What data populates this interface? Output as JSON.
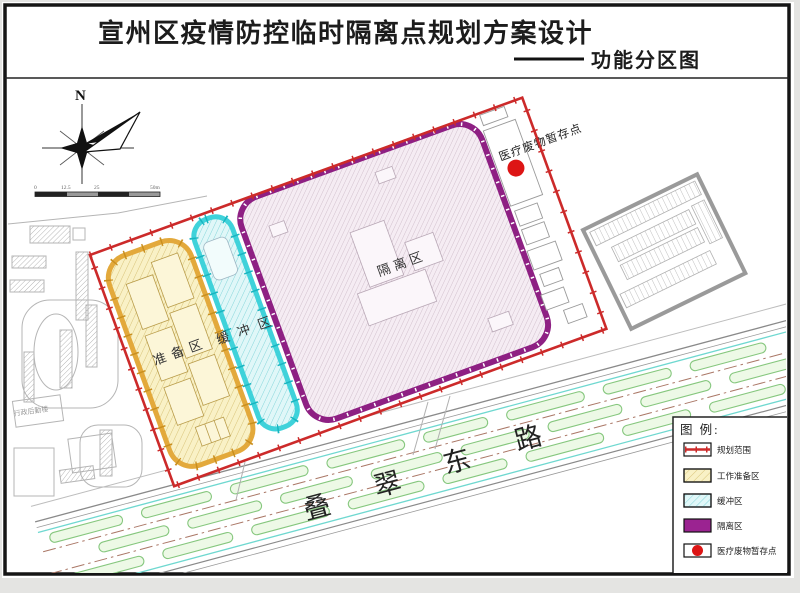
{
  "title": {
    "main": "宣州区疫情防控临时隔离点规划方案设计",
    "sub": "功能分区图"
  },
  "compass": {
    "north_label": "N"
  },
  "scalebar": {
    "labels": [
      "0",
      "12.5",
      "25",
      "50m"
    ]
  },
  "map": {
    "zones": {
      "preparation": "准备区",
      "buffer": "缓冲区",
      "isolation": "隔离区"
    },
    "annotations": {
      "medical_waste_point": "医疗废物暂存点"
    },
    "road": {
      "name": "叠翠东路",
      "chars": [
        "叠",
        "翠",
        "东",
        "路"
      ]
    },
    "campus_building_label": "行政后勤楼"
  },
  "legend": {
    "title": "图 例:",
    "items": [
      {
        "label": "规划范围",
        "swatch": "red-boundary-line"
      },
      {
        "label": "工作准备区",
        "swatch": "yellow-hatch"
      },
      {
        "label": "缓冲区",
        "swatch": "cyan-hatch"
      },
      {
        "label": "隔离区",
        "swatch": "purple-solid"
      },
      {
        "label": "医疗废物暂存点",
        "swatch": "red-dot"
      }
    ]
  },
  "colors": {
    "boundary_red": "#cc2a2a",
    "prep_border_yellow": "#e3a93b",
    "prep_fill": "#f9f1c6",
    "buffer_border_cyan": "#3fd2da",
    "buffer_fill": "#e0f7f8",
    "isolation_border_purple": "#8e2083",
    "isolation_fill": "#f5ecf3",
    "legend_purple": "#9b2391",
    "medical_dot_red": "#dd1515",
    "road_green": "#86c77e",
    "road_cyan": "#6fd8d0"
  }
}
